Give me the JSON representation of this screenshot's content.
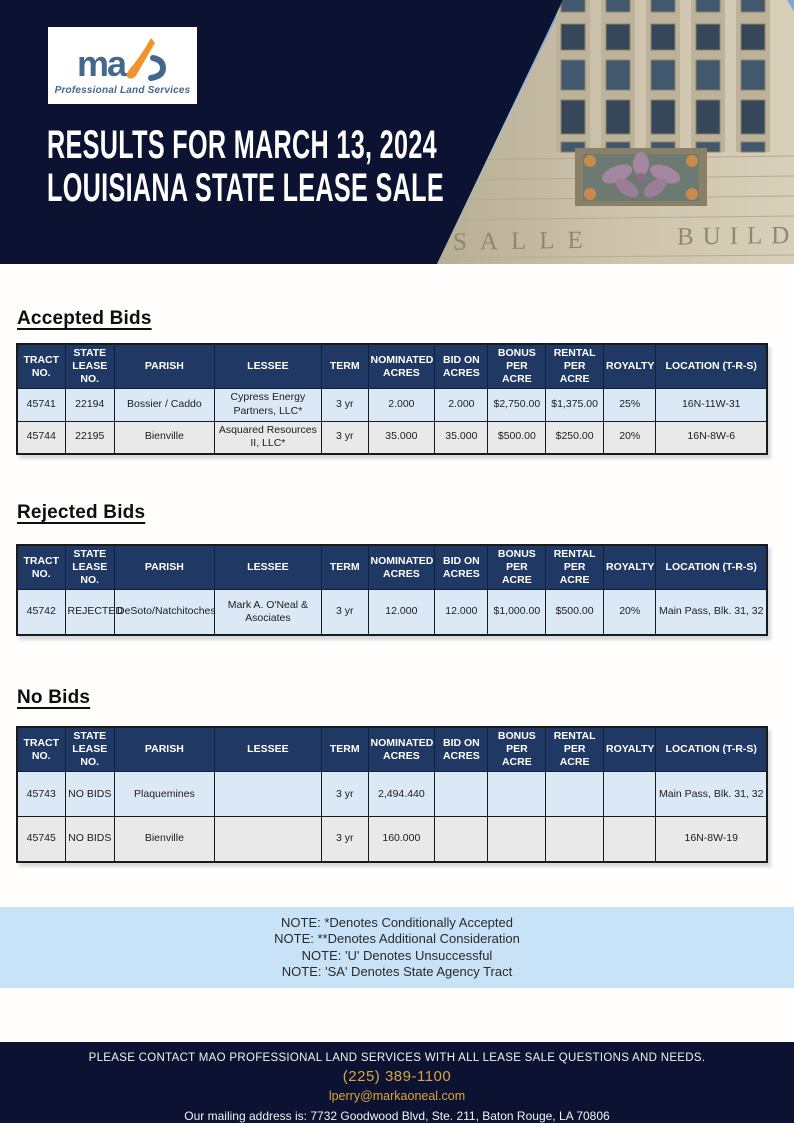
{
  "header": {
    "logo_text": "ma",
    "logo_subtitle": "Professional Land Services",
    "title_line1": "RESULTS FOR MARCH 13, 2024",
    "title_line2": "LOUISIANA STATE LEASE SALE",
    "building_inscription": {
      "left": "SALLE",
      "right": "BUILD"
    }
  },
  "table_columns": [
    "TRACT NO.",
    "STATE LEASE NO.",
    "PARISH",
    "LESSEE",
    "TERM",
    "NOMINATED ACRES",
    "BID ON ACRES",
    "BONUS PER ACRE",
    "RENTAL PER ACRE",
    "ROYALTY",
    "LOCATION (T-R-S)"
  ],
  "sections": [
    {
      "heading": "Accepted Bids",
      "rows": [
        [
          "45741",
          "22194",
          "Bossier / Caddo",
          "Cypress Energy Partners, LLC*",
          "3 yr",
          "2.000",
          "2.000",
          "$2,750.00",
          "$1,375.00",
          "25%",
          "16N-11W-31"
        ],
        [
          "45744",
          "22195",
          "Bienville",
          "Asquared Resources II, LLC*",
          "3 yr",
          "35.000",
          "35.000",
          "$500.00",
          "$250.00",
          "20%",
          "16N-8W-6"
        ]
      ]
    },
    {
      "heading": "Rejected Bids",
      "rows": [
        [
          "45742",
          "REJECTED",
          "DeSoto/Natchitoches",
          "Mark A. O'Neal & Asociates",
          "3 yr",
          "12.000",
          "12.000",
          "$1,000.00",
          "$500.00",
          "20%",
          "Main Pass, Blk. 31, 32"
        ]
      ]
    },
    {
      "heading": "No Bids",
      "rows": [
        [
          "45743",
          "NO BIDS",
          "Plaquemines",
          "",
          "3 yr",
          "2,494.440",
          "",
          "",
          "",
          "",
          "Main Pass, Blk. 31, 32"
        ],
        [
          "45745",
          "NO BIDS",
          "Bienville",
          "",
          "3 yr",
          "160.000",
          "",
          "",
          "",
          "",
          "16N-8W-19"
        ]
      ]
    }
  ],
  "notes": [
    "NOTE: *Denotes Conditionally Accepted",
    "NOTE: **Denotes Additional Consideration",
    "NOTE: 'U' Denotes Unsuccessful",
    "NOTE: 'SA' Denotes State Agency Tract"
  ],
  "footer": {
    "line1": "PLEASE CONTACT MAO PROFESSIONAL LAND SERVICES WITH ALL LEASE SALE QUESTIONS AND NEEDS.",
    "phone": "(225) 389-1100",
    "email": "lperry@markaoneal.com",
    "address": "Our mailing address is:  7732 Goodwood Blvd, Ste. 211, Baton Rouge, LA 70806"
  },
  "colors": {
    "banner_navy": "#0c1232",
    "table_header_navy": "#1f3864",
    "row_blue": "#dbe9f7",
    "row_gray": "#e9e9e9",
    "notes_blue": "#c8e3f8",
    "accent_gold": "#dba63c",
    "logo_blue": "#44688c",
    "logo_orange": "#f0932b"
  }
}
